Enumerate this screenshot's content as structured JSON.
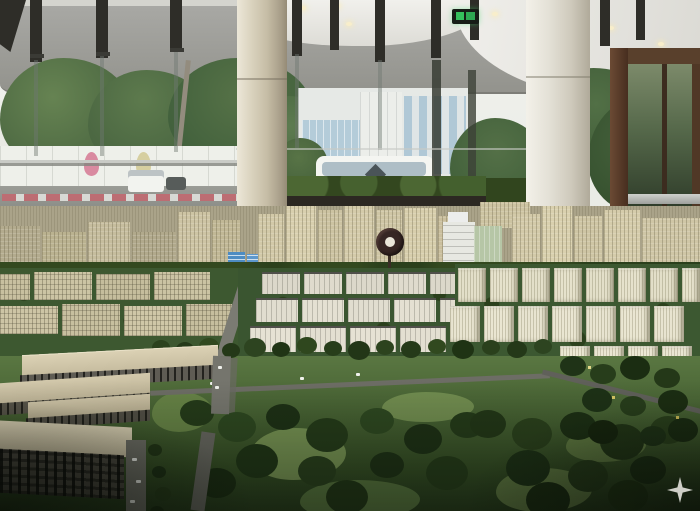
{
  "meta": {
    "kind": "photograph",
    "description": "Indoor photograph of a large master-plan city scale model displayed in a circular glass-walled showroom pavilion",
    "width_px": 700,
    "height_px": 511
  },
  "scene": {
    "interior": {
      "ceiling": "white curved ceiling with recessed warm downlights",
      "fascia_band": "grey exterior shade band seen through glazing",
      "glazing": "floor-to-ceiling glass wall with dark vertical glass fins and spider brackets",
      "columns_count": 2,
      "columns": "two large cream cylindrical structural columns",
      "entrance": "bronze framed glass entrance door at right",
      "exit_sign_label": "green emergency exit sign",
      "planters": "dark green hedge planter boxes along the glass"
    },
    "outside_view": {
      "weather": "overcast bright sky",
      "vegetation": "tropical trees and palm trees",
      "buildings": "white mid-rise buildings with blue glass facades",
      "fence": "white hoarding with droplet-shaped posters in pink, yellow and blue",
      "road_items": "red and white traffic barriers, white shuttle bus, white van",
      "water": "pale lake strip at right"
    },
    "model": {
      "subject": "miniature master-planned city",
      "back_row": "dense clusters of cream high-rise towers",
      "landmark": "white stepped landmark tower beside a green glass tower",
      "monument": "dark round clock monument on a post",
      "accent_buildings": "two bright blue glass mid-rises",
      "industrial": "grid of white flat-roof industrial blocks",
      "warehouses": "long tan-roofed logistics warehouses at left",
      "park": "large central forest park with tree clusters and lawns",
      "streets": "grey avenues lined with miniature trees and tiny white cars",
      "lit_windows": "a few tiny warm lit windows in the foreground"
    },
    "overlay": {
      "sparkle_label": "four-pointed sparkle watermark"
    }
  },
  "palette": {
    "fascia_grey": "#9b9b96",
    "ceiling_white": "#efeeea",
    "column_cream": "#d9d2bd",
    "door_bronze": "#59402c",
    "exit_green": "#35c05c",
    "model_cream": "#d4cbaa",
    "model_white": "#e6e2d4",
    "glass_blue": "#4e8cc2",
    "tree_dark": "#2b421d",
    "grass_green": "#5a7742",
    "warehouse_tan": "#cfc5a8",
    "sparkle_grey": "#d8d8d2"
  }
}
